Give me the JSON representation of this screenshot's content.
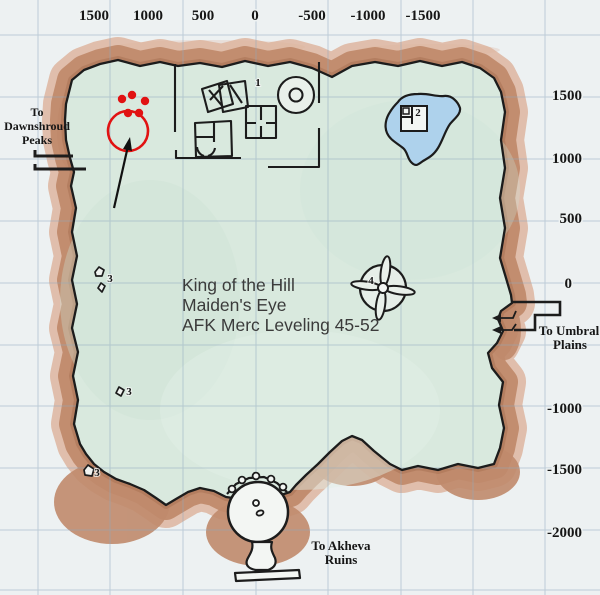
{
  "map": {
    "zone_overlay": [
      "King of the Hill",
      "Maiden's Eye",
      "AFK Merc Leveling 45-52"
    ],
    "axis_top": [
      "1500",
      "1000",
      "500",
      "0",
      "-500",
      "-1000",
      "-1500"
    ],
    "axis_right": [
      "1500",
      "1000",
      "500",
      "0",
      "-1000",
      "-1500",
      "-2000"
    ],
    "exits": {
      "dawnshroud": [
        "To",
        "Dawnshroud",
        "Peaks"
      ],
      "umbral": [
        "To Umbral",
        "Plains"
      ],
      "akheva": [
        "To Akheva",
        "Ruins"
      ]
    },
    "points_of_interest": [
      {
        "label": "1",
        "x": 258,
        "y": 86
      },
      {
        "label": "2",
        "x": 418,
        "y": 116
      },
      {
        "label": "3",
        "x": 110,
        "y": 282
      },
      {
        "label": "3",
        "x": 129,
        "y": 395
      },
      {
        "label": "3",
        "x": 97,
        "y": 476
      },
      {
        "label": "4",
        "x": 371,
        "y": 284
      }
    ],
    "annotation": {
      "description": "red circle with five red dots and a black arrow pointing at it",
      "color": "#e11212"
    },
    "colors": {
      "paper": "#edf1f2",
      "land": "#d9e9de",
      "border_main": "#c08a6c",
      "border_light": "#dcb29a",
      "pond": "#aed2ec",
      "ink": "#1c1c1c",
      "grid": "#8fa9bf",
      "red": "#e11212",
      "overlay_text": "#3b3b3b"
    }
  }
}
